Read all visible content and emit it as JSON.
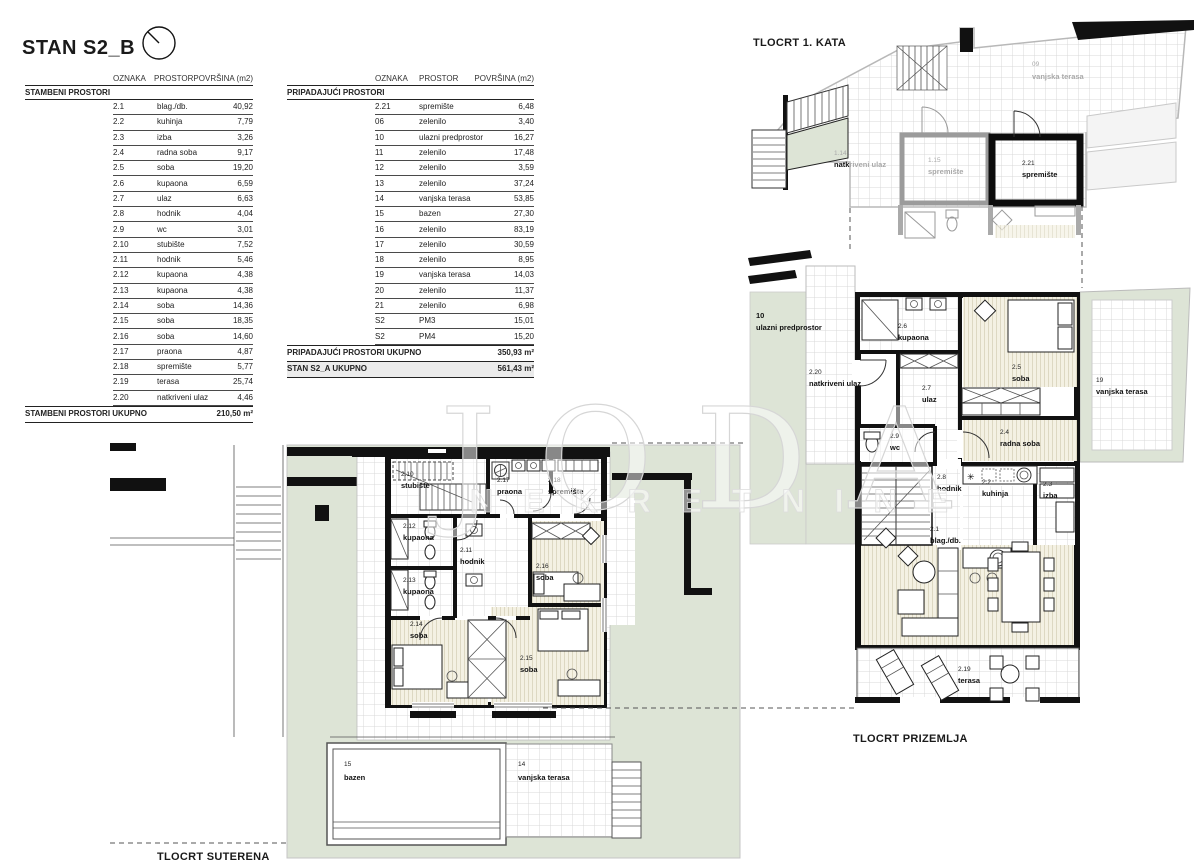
{
  "title": "STAN S2_B",
  "tables": {
    "headers": {
      "oznaka": "OZNAKA",
      "prostor": "PROSTOR",
      "povrsina": "POVRŠINA (m2)"
    },
    "left": {
      "section": "STAMBENI PROSTORI",
      "rows": [
        {
          "oznaka": "2.1",
          "prostor": "blag./db.",
          "povrsina": "40,92"
        },
        {
          "oznaka": "2.2",
          "prostor": "kuhinja",
          "povrsina": "7,79"
        },
        {
          "oznaka": "2.3",
          "prostor": "izba",
          "povrsina": "3,26"
        },
        {
          "oznaka": "2.4",
          "prostor": "radna soba",
          "povrsina": "9,17"
        },
        {
          "oznaka": "2.5",
          "prostor": "soba",
          "povrsina": "19,20"
        },
        {
          "oznaka": "2.6",
          "prostor": "kupaona",
          "povrsina": "6,59"
        },
        {
          "oznaka": "2.7",
          "prostor": "ulaz",
          "povrsina": "6,63"
        },
        {
          "oznaka": "2.8",
          "prostor": "hodnik",
          "povrsina": "4,04"
        },
        {
          "oznaka": "2.9",
          "prostor": "wc",
          "povrsina": "3,01"
        },
        {
          "oznaka": "2.10",
          "prostor": "stubište",
          "povrsina": "7,52"
        },
        {
          "oznaka": "2.11",
          "prostor": "hodnik",
          "povrsina": "5,46"
        },
        {
          "oznaka": "2.12",
          "prostor": "kupaona",
          "povrsina": "4,38"
        },
        {
          "oznaka": "2.13",
          "prostor": "kupaona",
          "povrsina": "4,38"
        },
        {
          "oznaka": "2.14",
          "prostor": "soba",
          "povrsina": "14,36"
        },
        {
          "oznaka": "2.15",
          "prostor": "soba",
          "povrsina": "18,35"
        },
        {
          "oznaka": "2.16",
          "prostor": "soba",
          "povrsina": "14,60"
        },
        {
          "oznaka": "2.17",
          "prostor": "praona",
          "povrsina": "4,87"
        },
        {
          "oznaka": "2.18",
          "prostor": "spremište",
          "povrsina": "5,77"
        },
        {
          "oznaka": "2.19",
          "prostor": "terasa",
          "povrsina": "25,74"
        },
        {
          "oznaka": "2.20",
          "prostor": "natkriveni ulaz",
          "povrsina": "4,46"
        }
      ],
      "footer": {
        "label": "STAMBENI PROSTORI UKUPNO",
        "value": "210,50 m²"
      }
    },
    "right": {
      "section": "PRIPADAJUĆI PROSTORI",
      "rows": [
        {
          "oznaka": "2.21",
          "prostor": "spremište",
          "povrsina": "6,48"
        },
        {
          "oznaka": "06",
          "prostor": "zelenilo",
          "povrsina": "3,40"
        },
        {
          "oznaka": "10",
          "prostor": "ulazni predprostor",
          "povrsina": "16,27"
        },
        {
          "oznaka": "11",
          "prostor": "zelenilo",
          "povrsina": "17,48"
        },
        {
          "oznaka": "12",
          "prostor": "zelenilo",
          "povrsina": "3,59"
        },
        {
          "oznaka": "13",
          "prostor": "zelenilo",
          "povrsina": "37,24"
        },
        {
          "oznaka": "14",
          "prostor": "vanjska terasa",
          "povrsina": "53,85"
        },
        {
          "oznaka": "15",
          "prostor": "bazen",
          "povrsina": "27,30"
        },
        {
          "oznaka": "16",
          "prostor": "zelenilo",
          "povrsina": "83,19"
        },
        {
          "oznaka": "17",
          "prostor": "zelenilo",
          "povrsina": "30,59"
        },
        {
          "oznaka": "18",
          "prostor": "zelenilo",
          "povrsina": "8,95"
        },
        {
          "oznaka": "19",
          "prostor": "vanjska terasa",
          "povrsina": "14,03"
        },
        {
          "oznaka": "20",
          "prostor": "zelenilo",
          "povrsina": "11,37"
        },
        {
          "oznaka": "21",
          "prostor": "zelenilo",
          "povrsina": "6,98"
        },
        {
          "oznaka": "S2",
          "prostor": "PM3",
          "povrsina": "15,01"
        },
        {
          "oznaka": "S2",
          "prostor": "PM4",
          "povrsina": "15,20"
        }
      ],
      "footers": [
        {
          "label": "PRIPADAJUĆI PROSTORI UKUPNO",
          "value": "350,93 m²"
        },
        {
          "label": "STAN S2_A UKUPNO",
          "value": "561,43 m²"
        }
      ]
    }
  },
  "plans": {
    "kata": {
      "caption": "TLOCRT 1. KATA",
      "labels": {
        "terasa09": {
          "id": "09",
          "name": "vanjska terasa"
        },
        "natkriveni114": {
          "id": "1.14",
          "name_bold": "natk",
          "name_rest": "riveni ulaz"
        },
        "spremiste115": {
          "id": "1.15",
          "name": "spremište"
        },
        "spremiste221": {
          "id": "2.21",
          "name": "spremište"
        }
      }
    },
    "prizemlje": {
      "caption": "TLOCRT PRIZEMLJA",
      "labels": {
        "predprostor10": {
          "id": "10",
          "name": "ulazni predprostor"
        },
        "natkriveni220": {
          "id": "2.20",
          "name": "natkriveni ulaz"
        },
        "kupaona26": {
          "id": "2.6",
          "name": "kupaona"
        },
        "ulaz27": {
          "id": "2.7",
          "name": "ulaz"
        },
        "soba25": {
          "id": "2.5",
          "name": "soba"
        },
        "terasa19": {
          "id": "19",
          "name": "vanjska terasa"
        },
        "wc29": {
          "id": "2.9",
          "name": "wc"
        },
        "radna24": {
          "id": "2.4",
          "name": "radna soba"
        },
        "hodnik28": {
          "id": "2.8",
          "name": "hodnik"
        },
        "kuhinja22": {
          "id": "2.2",
          "name": "kuhinja"
        },
        "izba23": {
          "id": "2.3",
          "name": "izba"
        },
        "blag21": {
          "id": "2.1",
          "name": "blag./db."
        },
        "terasa219": {
          "id": "2.19",
          "name": "terasa"
        }
      }
    },
    "suterena": {
      "caption": "TLOCRT SUTERENA",
      "labels": {
        "stubiste210": {
          "id": "2.10",
          "name": "stubište"
        },
        "praona217": {
          "id": "2.17",
          "name": "praona"
        },
        "spremiste218": {
          "id": "2.18",
          "name": "spremište"
        },
        "kupaona212": {
          "id": "2.12",
          "name": "kupaona"
        },
        "hodnik211": {
          "id": "2.11",
          "name": "hodnik"
        },
        "soba216": {
          "id": "2.16",
          "name": "soba"
        },
        "kupaona213": {
          "id": "2.13",
          "name": "kupaona"
        },
        "soba214": {
          "id": "2.14",
          "name": "soba"
        },
        "soba215": {
          "id": "2.15",
          "name": "soba"
        },
        "bazen15": {
          "id": "15",
          "name": "bazen"
        },
        "terasa14": {
          "id": "14",
          "name": "vanjska terasa"
        }
      }
    }
  },
  "watermark": {
    "line1": "JODA",
    "line2": "NEKRETNINE"
  },
  "colors": {
    "green": "#dde4d6",
    "wall": "#111111",
    "gray_plan": "#a9a9a9",
    "cream": "#f4f1e3",
    "highlight_row_bg": "#ebebeb"
  }
}
